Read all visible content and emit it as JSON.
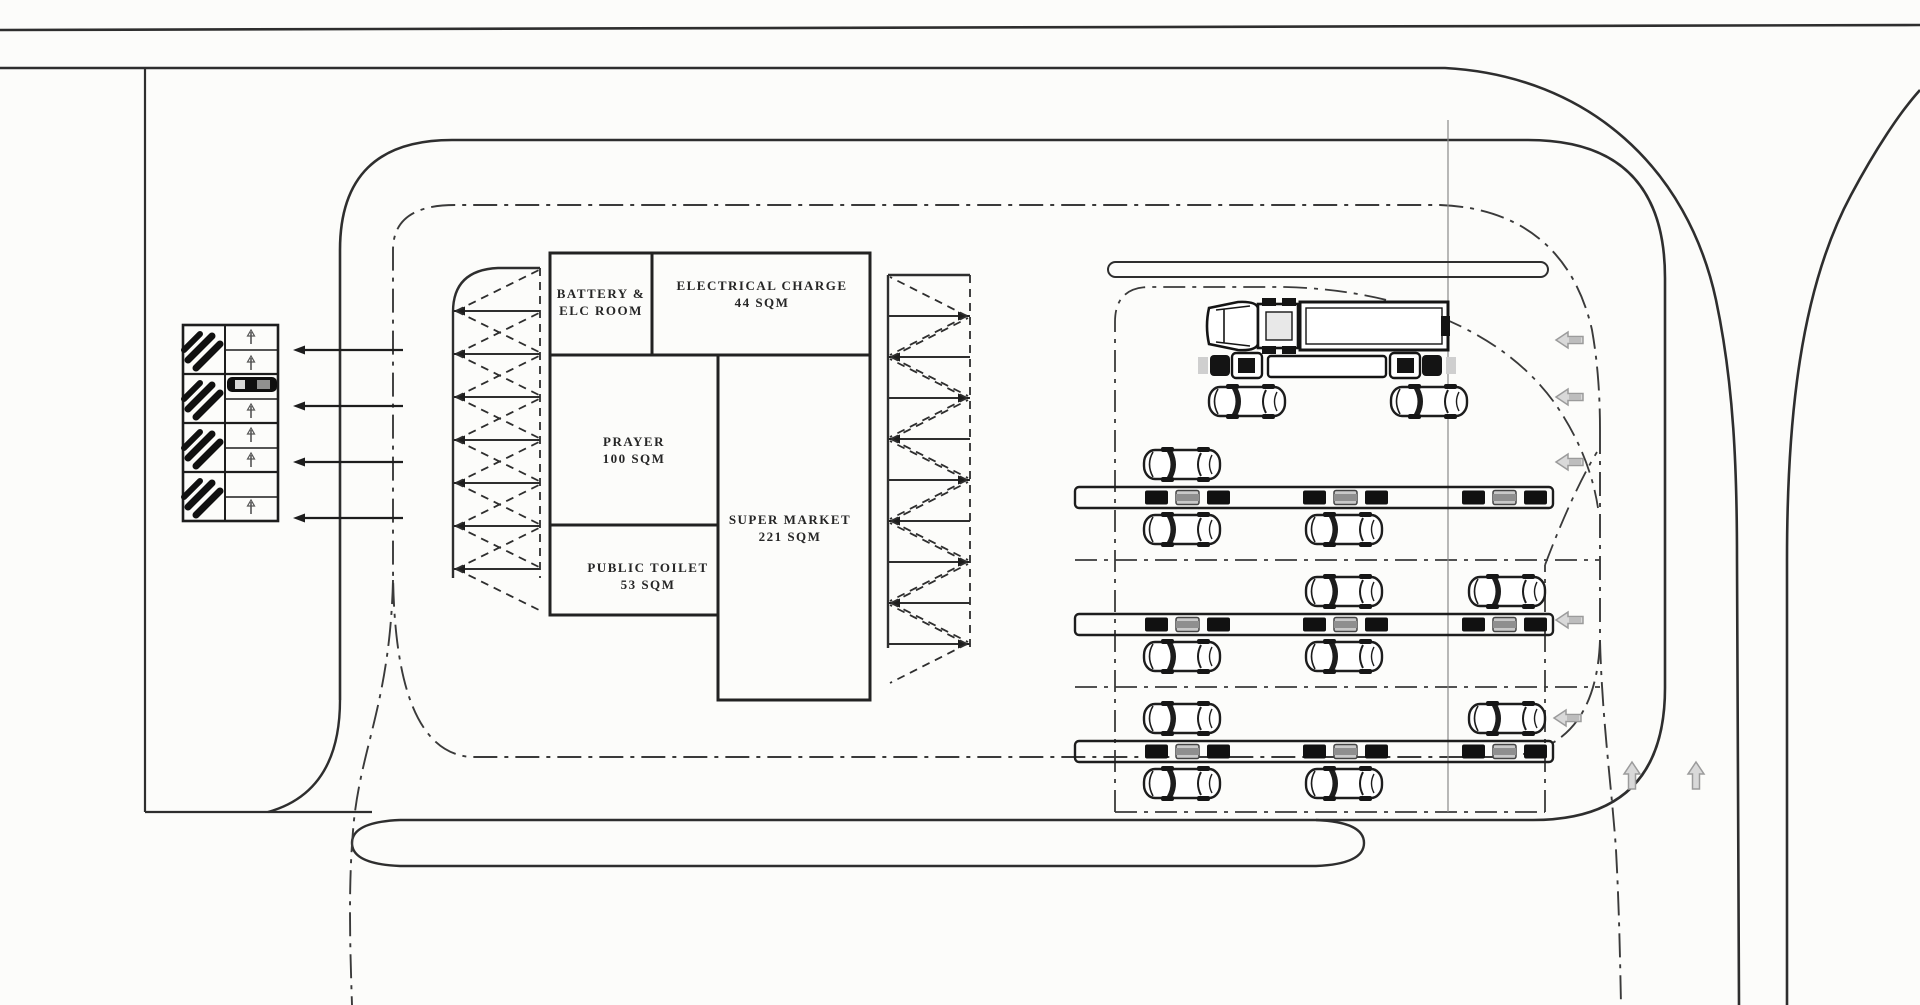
{
  "plan": {
    "title": "fuel-and-ev-station-site-plan",
    "rooms": {
      "battery": {
        "line1": "BATTERY &",
        "line2": "ELC ROOM"
      },
      "electrical_charge": {
        "name": "ELECTRICAL CHARGE",
        "area": "44 SQM"
      },
      "prayer": {
        "name": "PRAYER",
        "area": "100 SQM"
      },
      "super_market": {
        "name": "SUPER MARKET",
        "area": "221 SQM"
      },
      "public_toilet": {
        "name": "PUBLIC TOILET",
        "area": "53 SQM"
      }
    },
    "colors": {
      "line": "#2e2e2e",
      "thin_line": "#8a8a8a",
      "arrow_fill": "#d9d9d9",
      "arrow_stroke": "#9b9b9b",
      "vehicle_dark": "#161616",
      "background": "#fcfcfa"
    },
    "icons": [
      "fuel-pump-slash-icon",
      "dispenser-icon",
      "car-icon",
      "truck-icon",
      "charger-unit-icon",
      "left-arrow-icon",
      "up-arrow-icon"
    ],
    "counts": {
      "fuel_bays": 4,
      "charging_islands": 3,
      "parking_chevron_columns": 2
    }
  }
}
